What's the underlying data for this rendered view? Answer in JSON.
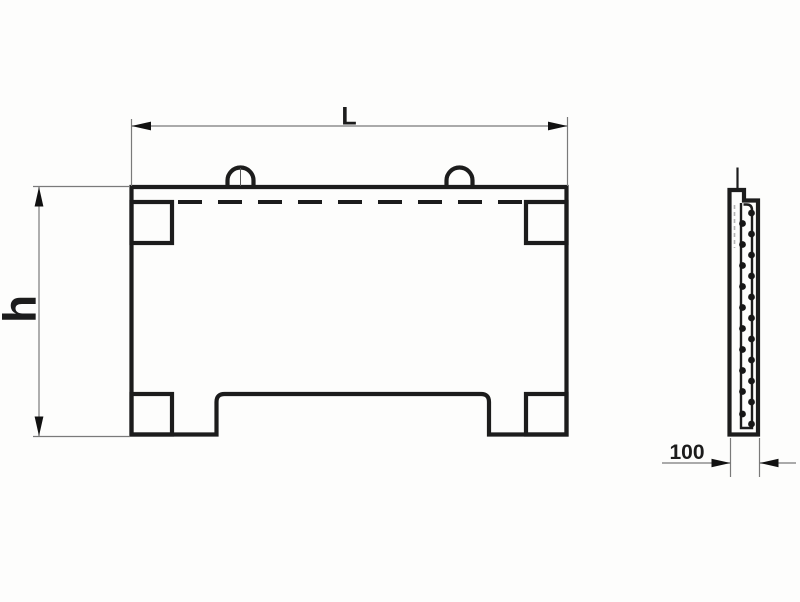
{
  "drawing": {
    "dimensions": {
      "length": {
        "label": "L"
      },
      "height": {
        "label": "h"
      },
      "thickness": {
        "label": "100"
      }
    },
    "colors": {
      "object_line": "#1c1c1c",
      "dimension_line": "#7a7a7a",
      "arrow": "#111111",
      "rebar_dashed_line": "#b3b3b3",
      "background": "#fdfdfc"
    }
  }
}
